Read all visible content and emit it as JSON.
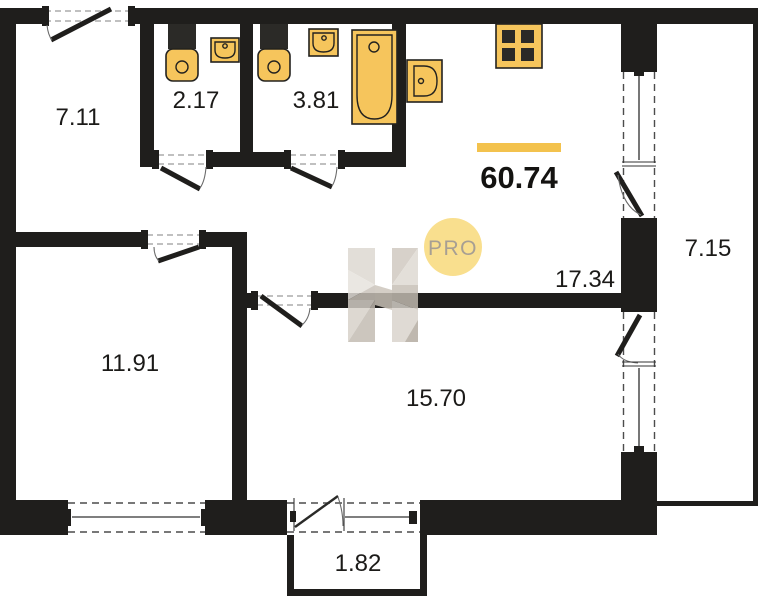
{
  "plan": {
    "total_area": "60.74",
    "rooms": [
      {
        "name": "hallway",
        "area": "7.11"
      },
      {
        "name": "wc",
        "area": "2.17"
      },
      {
        "name": "bathroom",
        "area": "3.81"
      },
      {
        "name": "kitchen-living-room",
        "area": "17.34"
      },
      {
        "name": "bedroom",
        "area": "11.91"
      },
      {
        "name": "room",
        "area": "15.70"
      },
      {
        "name": "loggia",
        "area": "7.15"
      },
      {
        "name": "balcony",
        "area": "1.82"
      }
    ],
    "watermark": {
      "badge": "PRO",
      "logo": "H"
    },
    "fixtures": [
      {
        "name": "toilet-wc"
      },
      {
        "name": "sink-wc"
      },
      {
        "name": "toilet-bathroom"
      },
      {
        "name": "sink-bathroom"
      },
      {
        "name": "bathtub"
      },
      {
        "name": "kitchen-sink"
      },
      {
        "name": "stove"
      }
    ],
    "colors": {
      "wall": "#1f1e1c",
      "fixture": "#f6c55c",
      "accent_bar": "#f3c24d",
      "badge_bg": "#f8d876",
      "badge_text": "#948a7c"
    }
  }
}
